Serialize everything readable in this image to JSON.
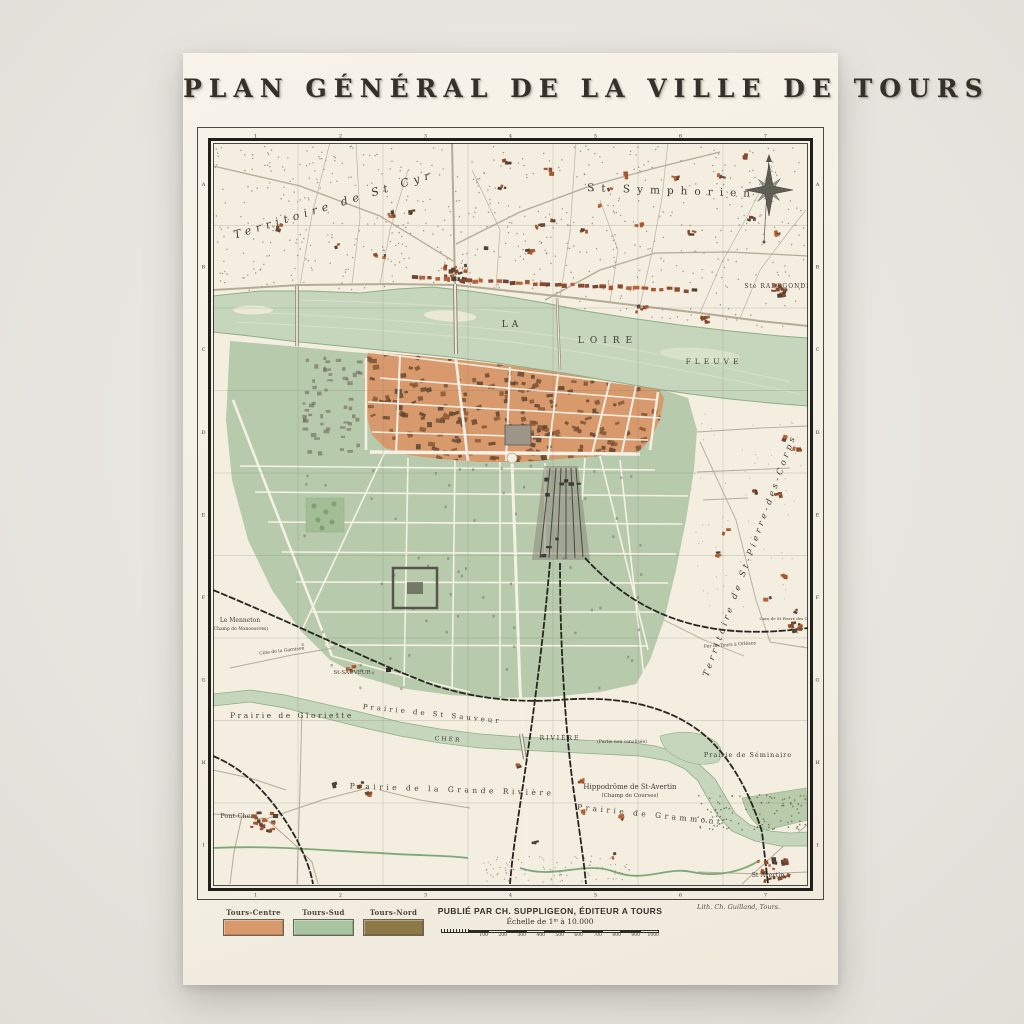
{
  "poster": {
    "title": "PLAN GÉNÉRAL DE LA VILLE DE TOURS",
    "publisher_line": "PUBLIÉ PAR CH. SUPPLIGEON, ÉDITEUR A TOURS",
    "scale_line": "Échelle de 1ᵐ à 10.000",
    "scale_ticks": [
      "100",
      "200",
      "300",
      "400",
      "500",
      "600",
      "700",
      "800",
      "900",
      "1000"
    ],
    "credit": "Lith. Ch. Guilland, Tours."
  },
  "legend": {
    "items": [
      {
        "label": "Tours-Centre",
        "color": "#d8996c"
      },
      {
        "label": "Tours-Sud",
        "color": "#a9c4a1"
      },
      {
        "label": "Tours-Nord",
        "color": "#8d7848"
      }
    ]
  },
  "map": {
    "grid": {
      "cols": [
        "1",
        "2",
        "3",
        "4",
        "5",
        "6",
        "7"
      ],
      "rows": [
        "A",
        "B",
        "C",
        "D",
        "E",
        "F",
        "G",
        "H",
        "I"
      ]
    },
    "labels": {
      "territoire_st_cyr": "Territoire de St Cyr",
      "st_symphorien": "St Symphorien",
      "ste_radegonde": "Ste RADEGONDE",
      "la": "LA",
      "loire": "LOIRE",
      "fleuve": "FLEUVE",
      "territoire_st_pierre": "Territoire de St-Pierre-des-Corps",
      "gare_st_pierre": "Gare de St Pierre des Corps",
      "fer_orleans": "Fer de Tours à Orléans",
      "le_menneton": "Le Menneton",
      "champ_manoeuvres": "(Champ de Manoeuvres)",
      "cote_garnison": "Côte de la Garnison",
      "st_sauveur": "St-SAUVEUR",
      "prairie_gloriette": "Prairie de Gloriette",
      "prairie_st_sauveur": "Prairie de St Sauveur",
      "cher": "CHER",
      "riviere": "RIVIÈRE",
      "partie_non_canalisee": "(Partie non canalisée)",
      "prairie_grande_riviere": "Prairie de la Grande Rivière",
      "hippodrome": "Hippodrôme de St-Avertin",
      "champ_courses": "(Champ de Courses)",
      "prairie_grammont": "Prairie de Grammont",
      "prairie_seminaire": "Prairie de Séminaire",
      "pont_cher": "Pont-Cher",
      "st_avertin": "St Avertin"
    },
    "colors": {
      "background": "#e9e6e1",
      "paper": "#f5f1e7",
      "map_base": "#f3eee0",
      "river": "#c6d6bc",
      "river_edge": "#8fae84",
      "tours_centre": "#d8996c",
      "tours_sud": "#b7cbac",
      "tours_nord": "#8d7848",
      "building": "#a8562f",
      "railway": "#26251f",
      "frame": "#201f1b",
      "road": "#b5ab97",
      "text": "#3e3d36"
    }
  }
}
